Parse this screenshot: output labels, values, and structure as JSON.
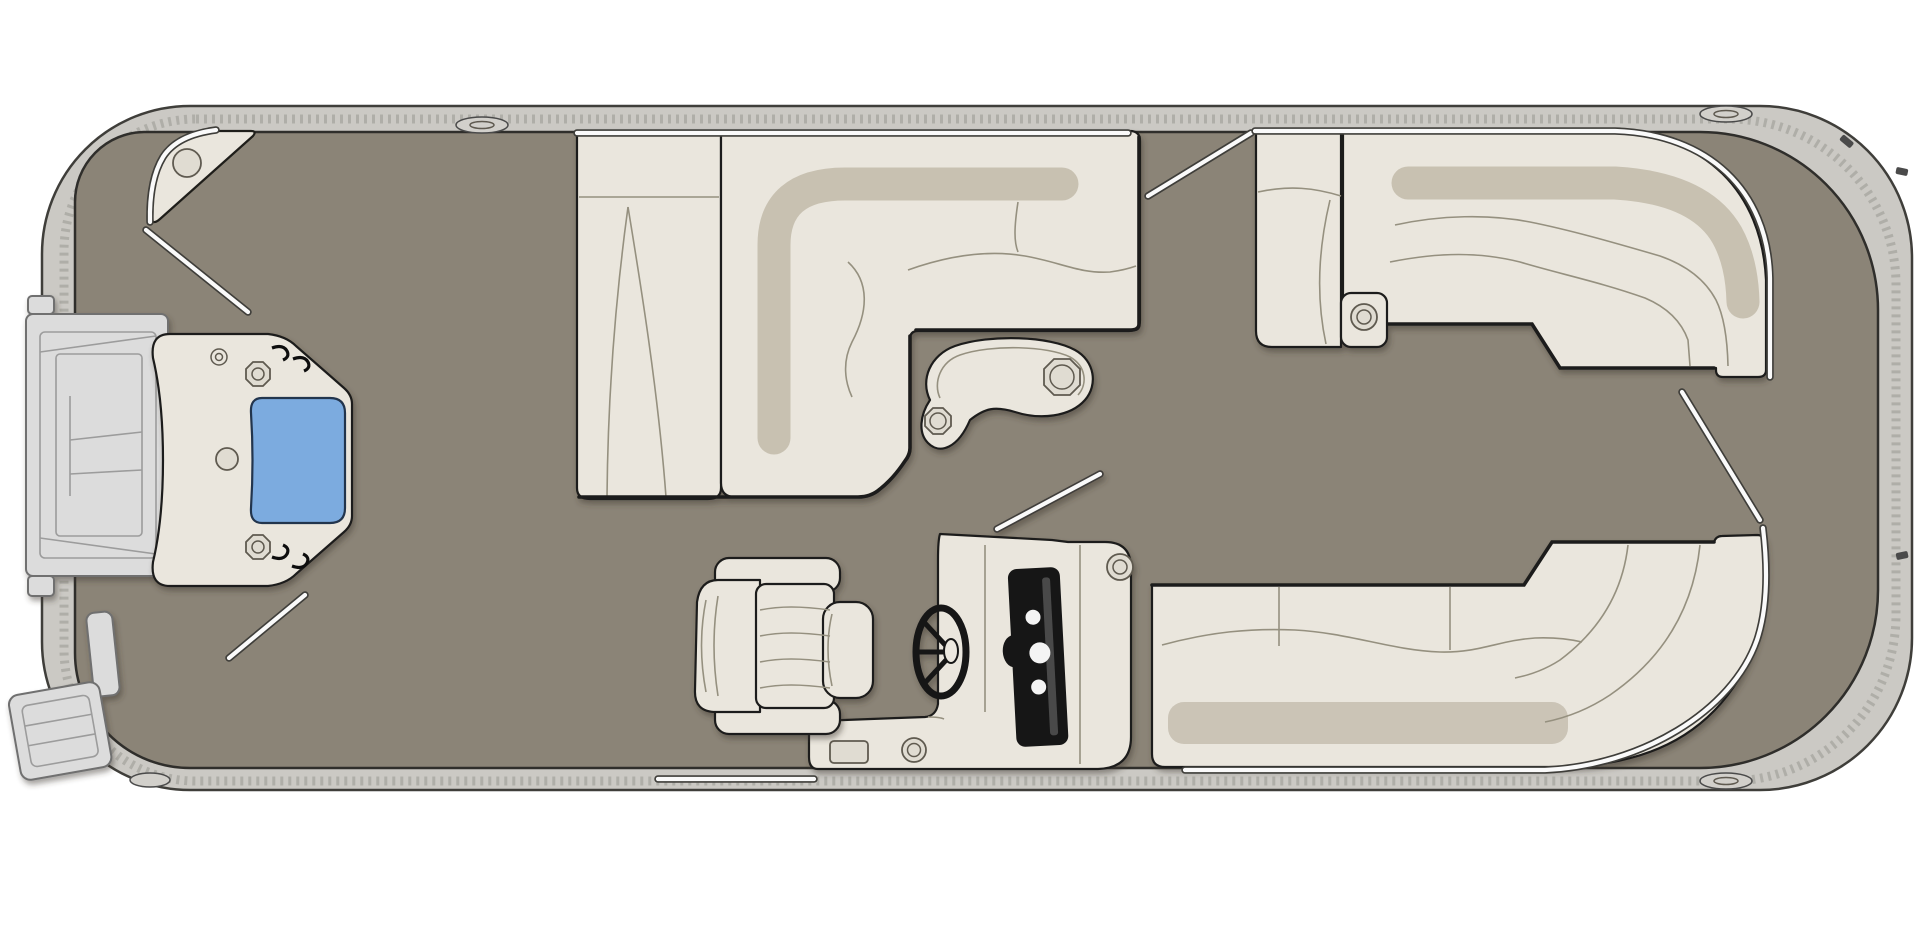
{
  "diagram": {
    "type": "floor-plan",
    "subject": "pontoon-boat-deck-plan-top-view",
    "visible_text": [],
    "colors": {
      "background": "#ffffff",
      "deck": "#8b8477",
      "rail": "#cbc9c4",
      "hullOutline": "#3f3e3a",
      "ropeDash": "#8f8d88",
      "seat": "#eae6dd",
      "seatBand": "#c8c1b1",
      "seatShadow": "#c3bcac",
      "seam": "#95907f",
      "heavy": "#1f1e1a",
      "table": "#e7e2d8",
      "consoleBlack": "#161616",
      "gaugeWhite": "#f4f4f4",
      "blue": "#7cabdf",
      "blueOutline": "#24344d",
      "white": "#fafafa",
      "platform": "#dcdcdc",
      "platformLine": "#6f6f6f"
    }
  },
  "components": [
    {
      "name": "hull-rail",
      "kind": "boat-structure"
    },
    {
      "name": "deck-floor",
      "kind": "boat-structure"
    },
    {
      "name": "bow-corner-step",
      "kind": "seating"
    },
    {
      "name": "bow-boarding-platform",
      "kind": "access"
    },
    {
      "name": "bow-gate-door-blue-panel",
      "kind": "access"
    },
    {
      "name": "boarding-ladder",
      "kind": "access"
    },
    {
      "name": "port-chaise-bench",
      "kind": "seating"
    },
    {
      "name": "port-l-lounge",
      "kind": "seating"
    },
    {
      "name": "cocktail-table-with-cupholders",
      "kind": "furniture"
    },
    {
      "name": "starboard-chaise-seat",
      "kind": "seating"
    },
    {
      "name": "starboard-armrest-cupholder",
      "kind": "furniture"
    },
    {
      "name": "starboard-bow-curved-lounge",
      "kind": "seating"
    },
    {
      "name": "stern-curved-bench",
      "kind": "seating"
    },
    {
      "name": "helm-console",
      "kind": "helm"
    },
    {
      "name": "steering-wheel",
      "kind": "helm"
    },
    {
      "name": "captain-chair",
      "kind": "seating"
    },
    {
      "name": "gate-opening-lines",
      "kind": "access"
    },
    {
      "name": "rail-cleats",
      "kind": "boat-structure"
    }
  ]
}
